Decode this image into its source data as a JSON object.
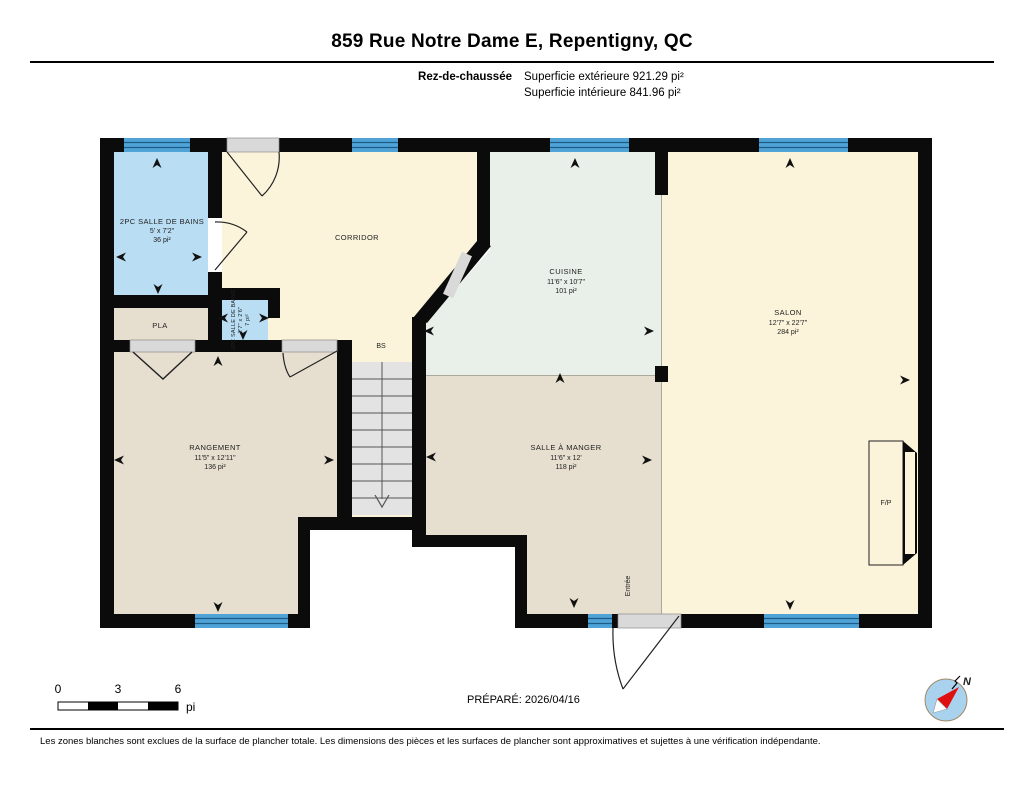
{
  "header": {
    "title": "859 Rue Notre Dame E, Repentigny, QC",
    "floor_label": "Rez-de-chaussée",
    "exterior_area": "Superficie extérieure 921.29 pi²",
    "interior_area": "Superficie intérieure 841.96 pi²"
  },
  "rooms": {
    "bathroom": {
      "name": "2PC SALLE DE BAINS",
      "dims": "5' x 7'2\"",
      "area": "36 pi²"
    },
    "small_bathroom": {
      "name": "2PC SALLE DE BAINS",
      "dims": "2'7\" x 2'6\"",
      "area": "7 pi²"
    },
    "corridor": {
      "name": "CORRIDOR"
    },
    "pla": {
      "name": "PLA"
    },
    "bs": {
      "name": "BS"
    },
    "cuisine": {
      "name": "CUISINE",
      "dims": "11'6\" x 10'7\"",
      "area": "101 pi²"
    },
    "salon": {
      "name": "SALON",
      "dims": "12'7\" x 22'7\"",
      "area": "284 pi²"
    },
    "rangement": {
      "name": "RANGEMENT",
      "dims": "11'5\" x 12'11\"",
      "area": "136 pi²"
    },
    "salle_a_manger": {
      "name": "SALLE À MANGER",
      "dims": "11'6\" x 12'",
      "area": "118 pi²"
    },
    "fireplace": {
      "name": "F/P"
    },
    "entree": {
      "name": "Entrée"
    }
  },
  "scale_bar": {
    "tick0": "0",
    "tick3": "3",
    "tick6": "6",
    "unit": "pi"
  },
  "prepared_label": "PRÉPARÉ: 2026/04/16",
  "footer_note": "Les zones blanches sont exclues de la surface de plancher totale. Les dimensions des pièces et les surfaces de plancher sont approximatives et sujettes à une vérification indépendante.",
  "compass": {
    "north_label": "N"
  },
  "colors": {
    "wall": "#0b0b0b",
    "window": "#4fa3d6",
    "bathroom_blue": "#b9ddf3",
    "cream": "#fbf4da",
    "kitchen_green": "#e9efe9",
    "beige": "#e6decf",
    "stairs_gray": "#e3e3e3",
    "door_gray": "#d9d9d9",
    "compass_blue": "#a9d2ee",
    "compass_red": "#e01010"
  }
}
